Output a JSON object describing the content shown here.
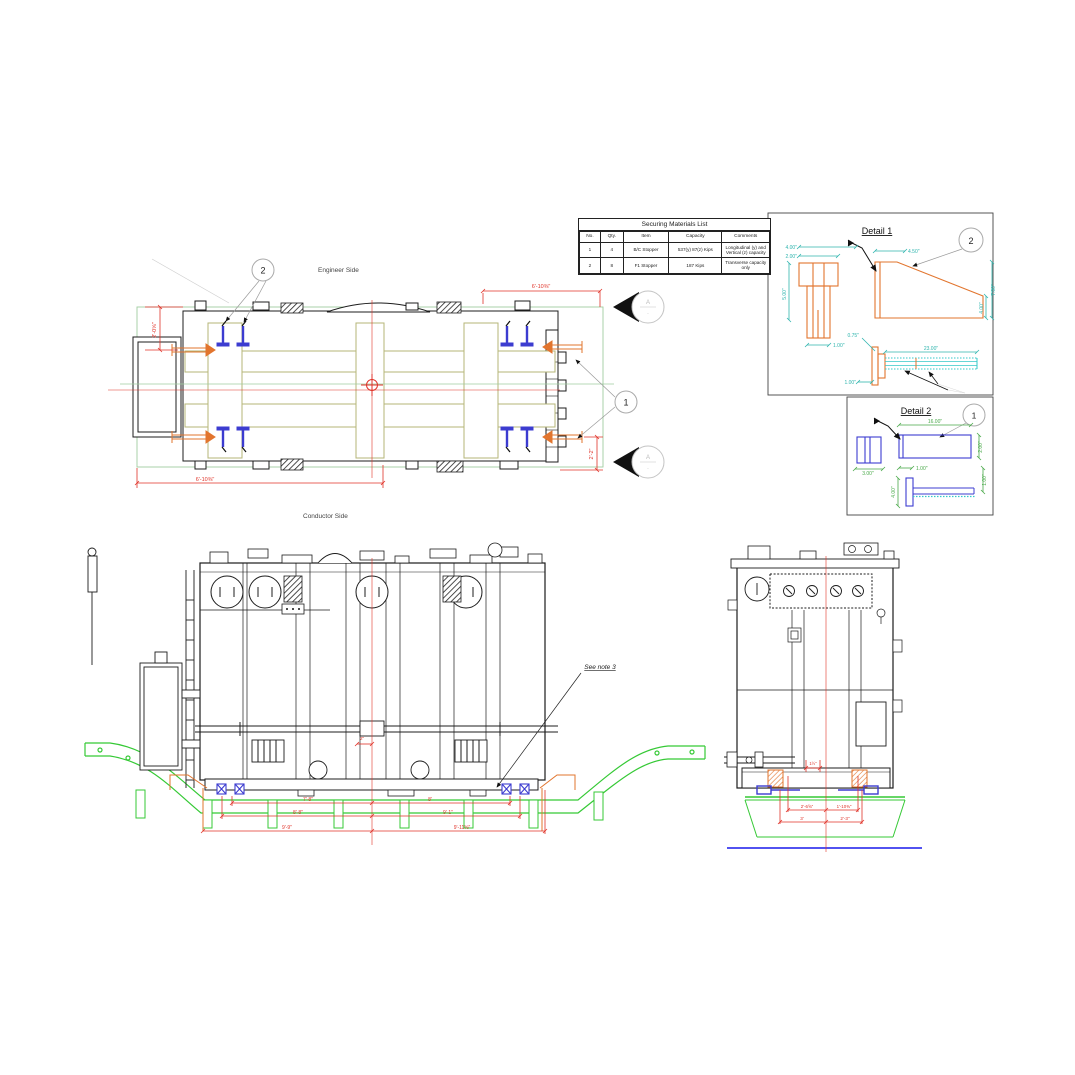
{
  "colors": {
    "line_black": "#1c1c1c",
    "beam_olive": "#b5b577",
    "dim_red": "#e03228",
    "plan_green": "#9fce9f",
    "deck_green": "#35c935",
    "stopper_blue": "#3c3cd0",
    "rail_blue": "#3a3aee",
    "thread_cyan": "#35c8c8",
    "detail1_dim_teal": "#2fb5ae",
    "detail2_dim_green": "#49a949",
    "stopper_orange": "#e2752e",
    "leader_gray": "#9a9a9a"
  },
  "table": {
    "title": "Securing Materials List",
    "headers": [
      "No.",
      "Qty.",
      "Item",
      "Capacity",
      "Comments"
    ],
    "rows": [
      {
        "no": "1",
        "qty": "4",
        "item": "B/C Stopper",
        "capacity": "537(y) 87(z) Kips",
        "comments": "Longitudinal (y) and Vertical (z) capacity"
      },
      {
        "no": "2",
        "qty": "8",
        "item": "F1 Stopper",
        "capacity": "187 Kips",
        "comments": "Transverse capacity only"
      }
    ]
  },
  "plan": {
    "engineer_side_label": "Engineer Side",
    "conductor_side_label": "Conductor Side",
    "dim_top": "6'-10⅜\"",
    "dim_bottom": "6'-10⅜\"",
    "dim_left": "2'-0⅝\"",
    "dim_right": "2'-2\"",
    "callout_f1": "2",
    "callout_bc": "1",
    "section_letter": "A"
  },
  "detail1": {
    "title": "Detail 1",
    "callout": "2",
    "dim_cap_top": "4.00\"",
    "dim_cap_inner": "2.00\"",
    "dim_height": "5.00\"",
    "dim_stem": "1.00\"",
    "dim_wedge_top": "4.50\"",
    "dim_wedge_right_outer": "7.00\"",
    "dim_wedge_right_inner": "4.00\"",
    "dim_bolt_head": "0.75\"",
    "dim_bolt_length": "23.00\"",
    "dim_bolt_flange": "1.00\""
  },
  "detail2": {
    "title": "Detail 2",
    "callout": "1",
    "dim_length": "16.00\"",
    "dim_height": "2.00\"",
    "dim_end": "3.00\"",
    "dim_left": "1.00\"",
    "dim_bolt_plate": "4.00\"",
    "dim_bolt_right": "1.00\""
  },
  "front": {
    "see_note": "See note 3",
    "dim_small": "2\"",
    "dim_row1_left": "7'-8\"",
    "dim_row1_right": "8'",
    "dim_row2_left": "8'-8\"",
    "dim_row2_right": "9'-1\"",
    "dim_row3_left": "9'-9\"",
    "dim_row3_right": "9'-11⅝\""
  },
  "side": {
    "dim_small": "1½\"",
    "dim_row1_left": "2'-6⅝\"",
    "dim_row1_right": "1'-10⅜\"",
    "dim_row2_left": "3'",
    "dim_row2_right": "2'-3\""
  }
}
